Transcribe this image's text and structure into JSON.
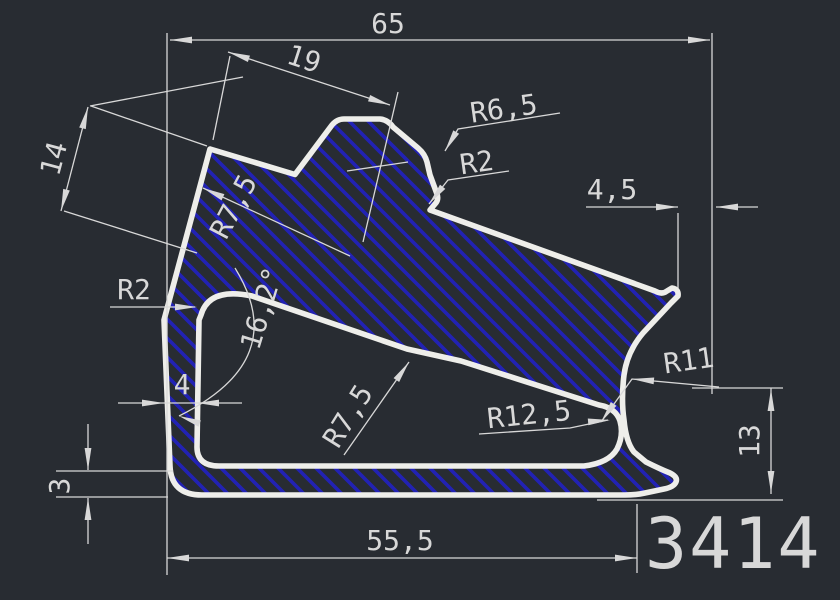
{
  "drawing": {
    "type": "cad-profile-cross-section",
    "part_number": "3414",
    "labels": {
      "dim_65": "65",
      "dim_19": "19",
      "r_6_5": "R6,5",
      "r_2_top": "R2",
      "dim_4_5": "4,5",
      "dim_14": "14",
      "r_7_5_left": "R7,5",
      "angle_16_2": "16,2°",
      "r_2_left": "R2",
      "dim_4": "4",
      "r_7_5_mid": "R7,5",
      "r_12_5": "R12,5",
      "r_11": "R11",
      "dim_13": "13",
      "dim_3": "3",
      "dim_55_5": "55,5"
    },
    "colors": {
      "background": "#282c32",
      "profile_outline": "#eeeeea",
      "hatch_blue": "#2222b4",
      "dimension_lines": "#d8d8d8"
    }
  }
}
